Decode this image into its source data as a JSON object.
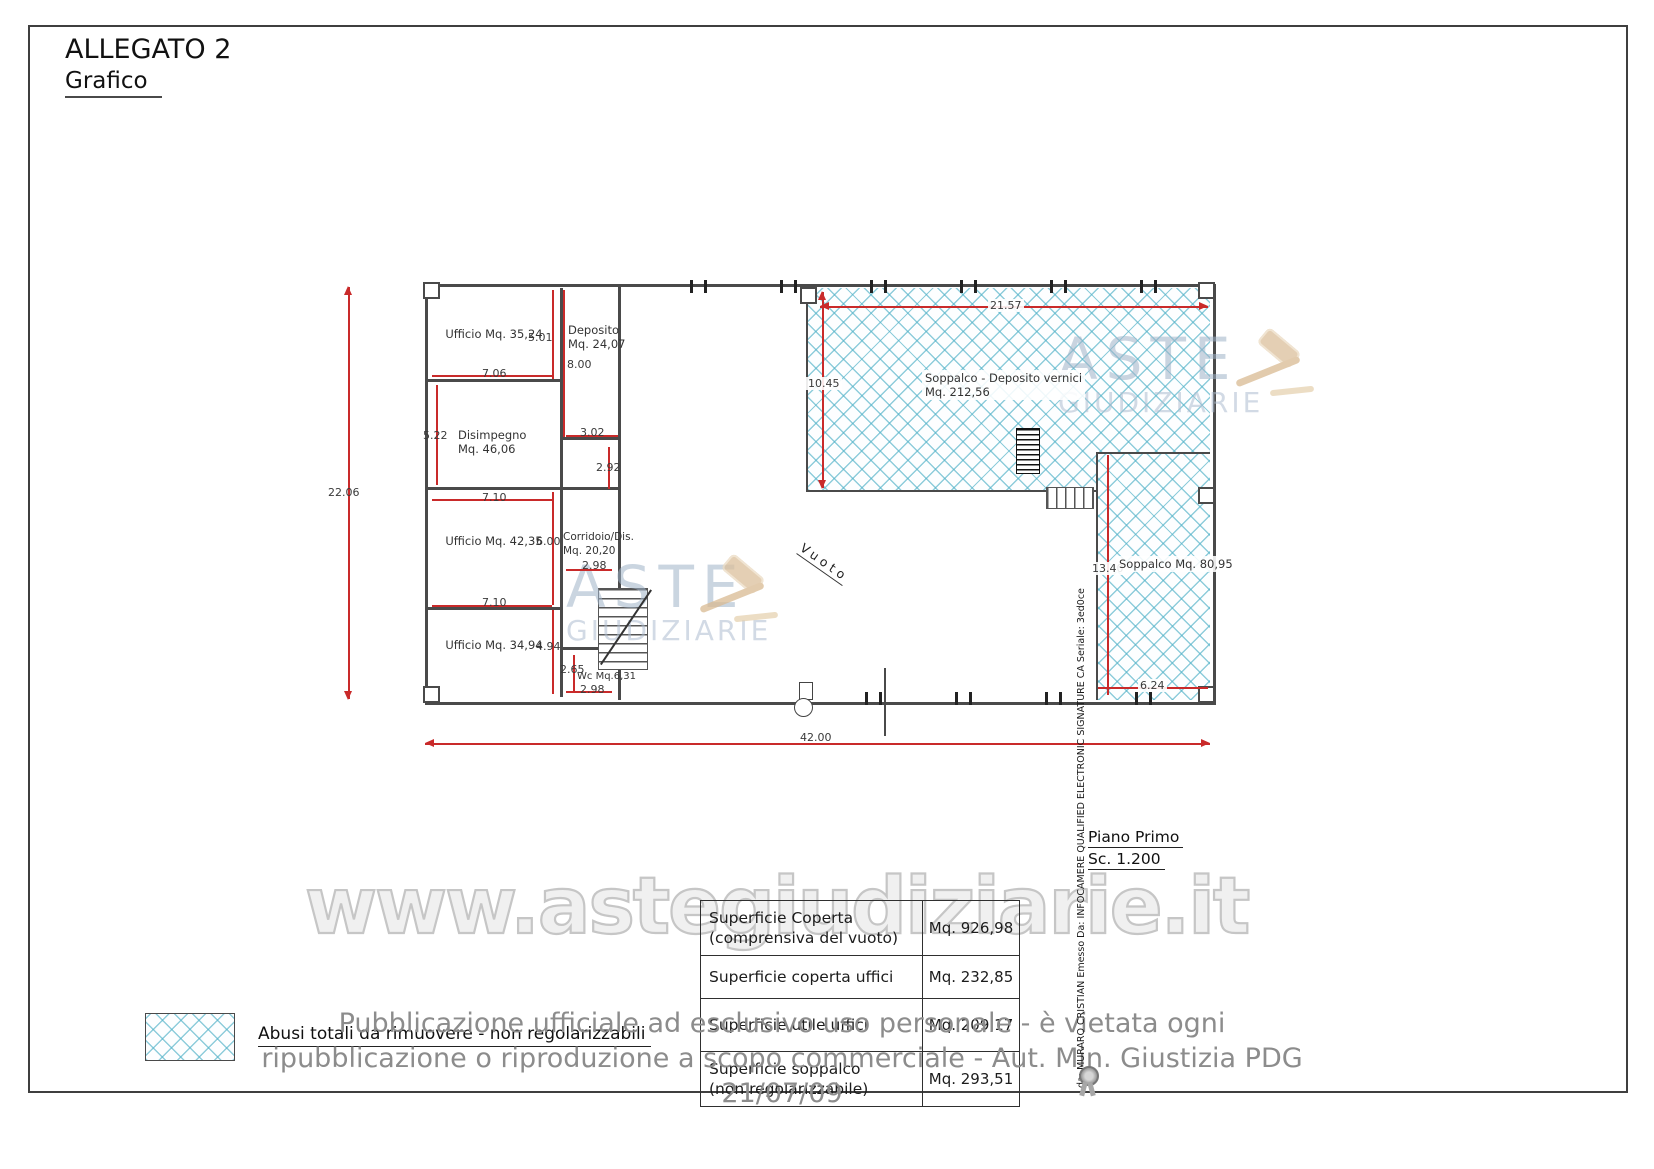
{
  "header": {
    "title": "ALLEGATO 2",
    "subtitle": "Grafico"
  },
  "plan": {
    "rooms": {
      "ufficio_1": "Ufficio Mq. 35,24",
      "deposito": "Deposito\nMq. 24,07",
      "disimpegno": "Disimpegno\nMq. 46,06",
      "ufficio_2": "Ufficio Mq. 42,35",
      "corridoio": "Corridoio/Dis.\nMq. 20,20",
      "ufficio_3": "Ufficio Mq. 34,94",
      "wc": "Wc Mq.6,31",
      "soppalco_deposito": "Soppalco - Deposito vernici\nMq. 212,56",
      "soppalco_right": "Soppalco Mq. 80,95",
      "vuoto": "Vuoto"
    },
    "dims": {
      "total_h": "22.06",
      "total_w": "42.00",
      "d501": "5.01",
      "d706": "7.06",
      "d800": "8.00",
      "d302": "3.02",
      "d522": "5.22",
      "d292": "2.92",
      "d710a": "7.10",
      "d600": "6.00",
      "d298a": "2.98",
      "d710b": "7.10",
      "d494": "4.94",
      "d265": "2.65",
      "d298b": "2.98",
      "d2157": "21.57",
      "d1045": "10.45",
      "d1340": "13.40",
      "d624": "6.24"
    },
    "scale_note": {
      "line1": "Piano Primo",
      "line2": "Sc. 1.200"
    }
  },
  "legend": {
    "label": "Abusi totali da rimuovere - non regolarizzabili"
  },
  "table": {
    "rows": [
      {
        "label": "Superficie Coperta\n(comprensiva del vuoto)",
        "value": "Mq. 926,98"
      },
      {
        "label": "Superficie coperta uffici",
        "value": "Mq. 232,85"
      },
      {
        "label": "Superficie utile uffici",
        "value": "Mq. 209,17"
      },
      {
        "label": "Superficie soppalco\n(non regolarizzabile)",
        "value": "Mq. 293,51"
      }
    ]
  },
  "watermark": {
    "url": "www.astegiudiziarie.it",
    "brand_top": "ASTE",
    "brand_bottom": "GIUDIZIARIE"
  },
  "signature": {
    "text": "da: MURARO CRISTIAN Emesso Da: INFOCAMERE QUALIFIED ELECTRONIC SIGNATURE CA Seriale: 3ed0ce"
  },
  "footer": {
    "line1": "Pubblicazione ufficiale ad esclusivo uso personale - è vietata ogni",
    "line2": "ripubblicazione o riproduzione a scopo commerciale - Aut. Min. Giustizia PDG 21/07/09",
    "dash": "-"
  },
  "colors": {
    "dimension_red": "#c92a2a",
    "hatch_blue": "#52b2c8",
    "wall_gray": "#4a4a4a",
    "watermark_gray": "#c6c6c6",
    "brand_blue": "#9fb3c8",
    "gavel_tan": "#dcc09c"
  }
}
